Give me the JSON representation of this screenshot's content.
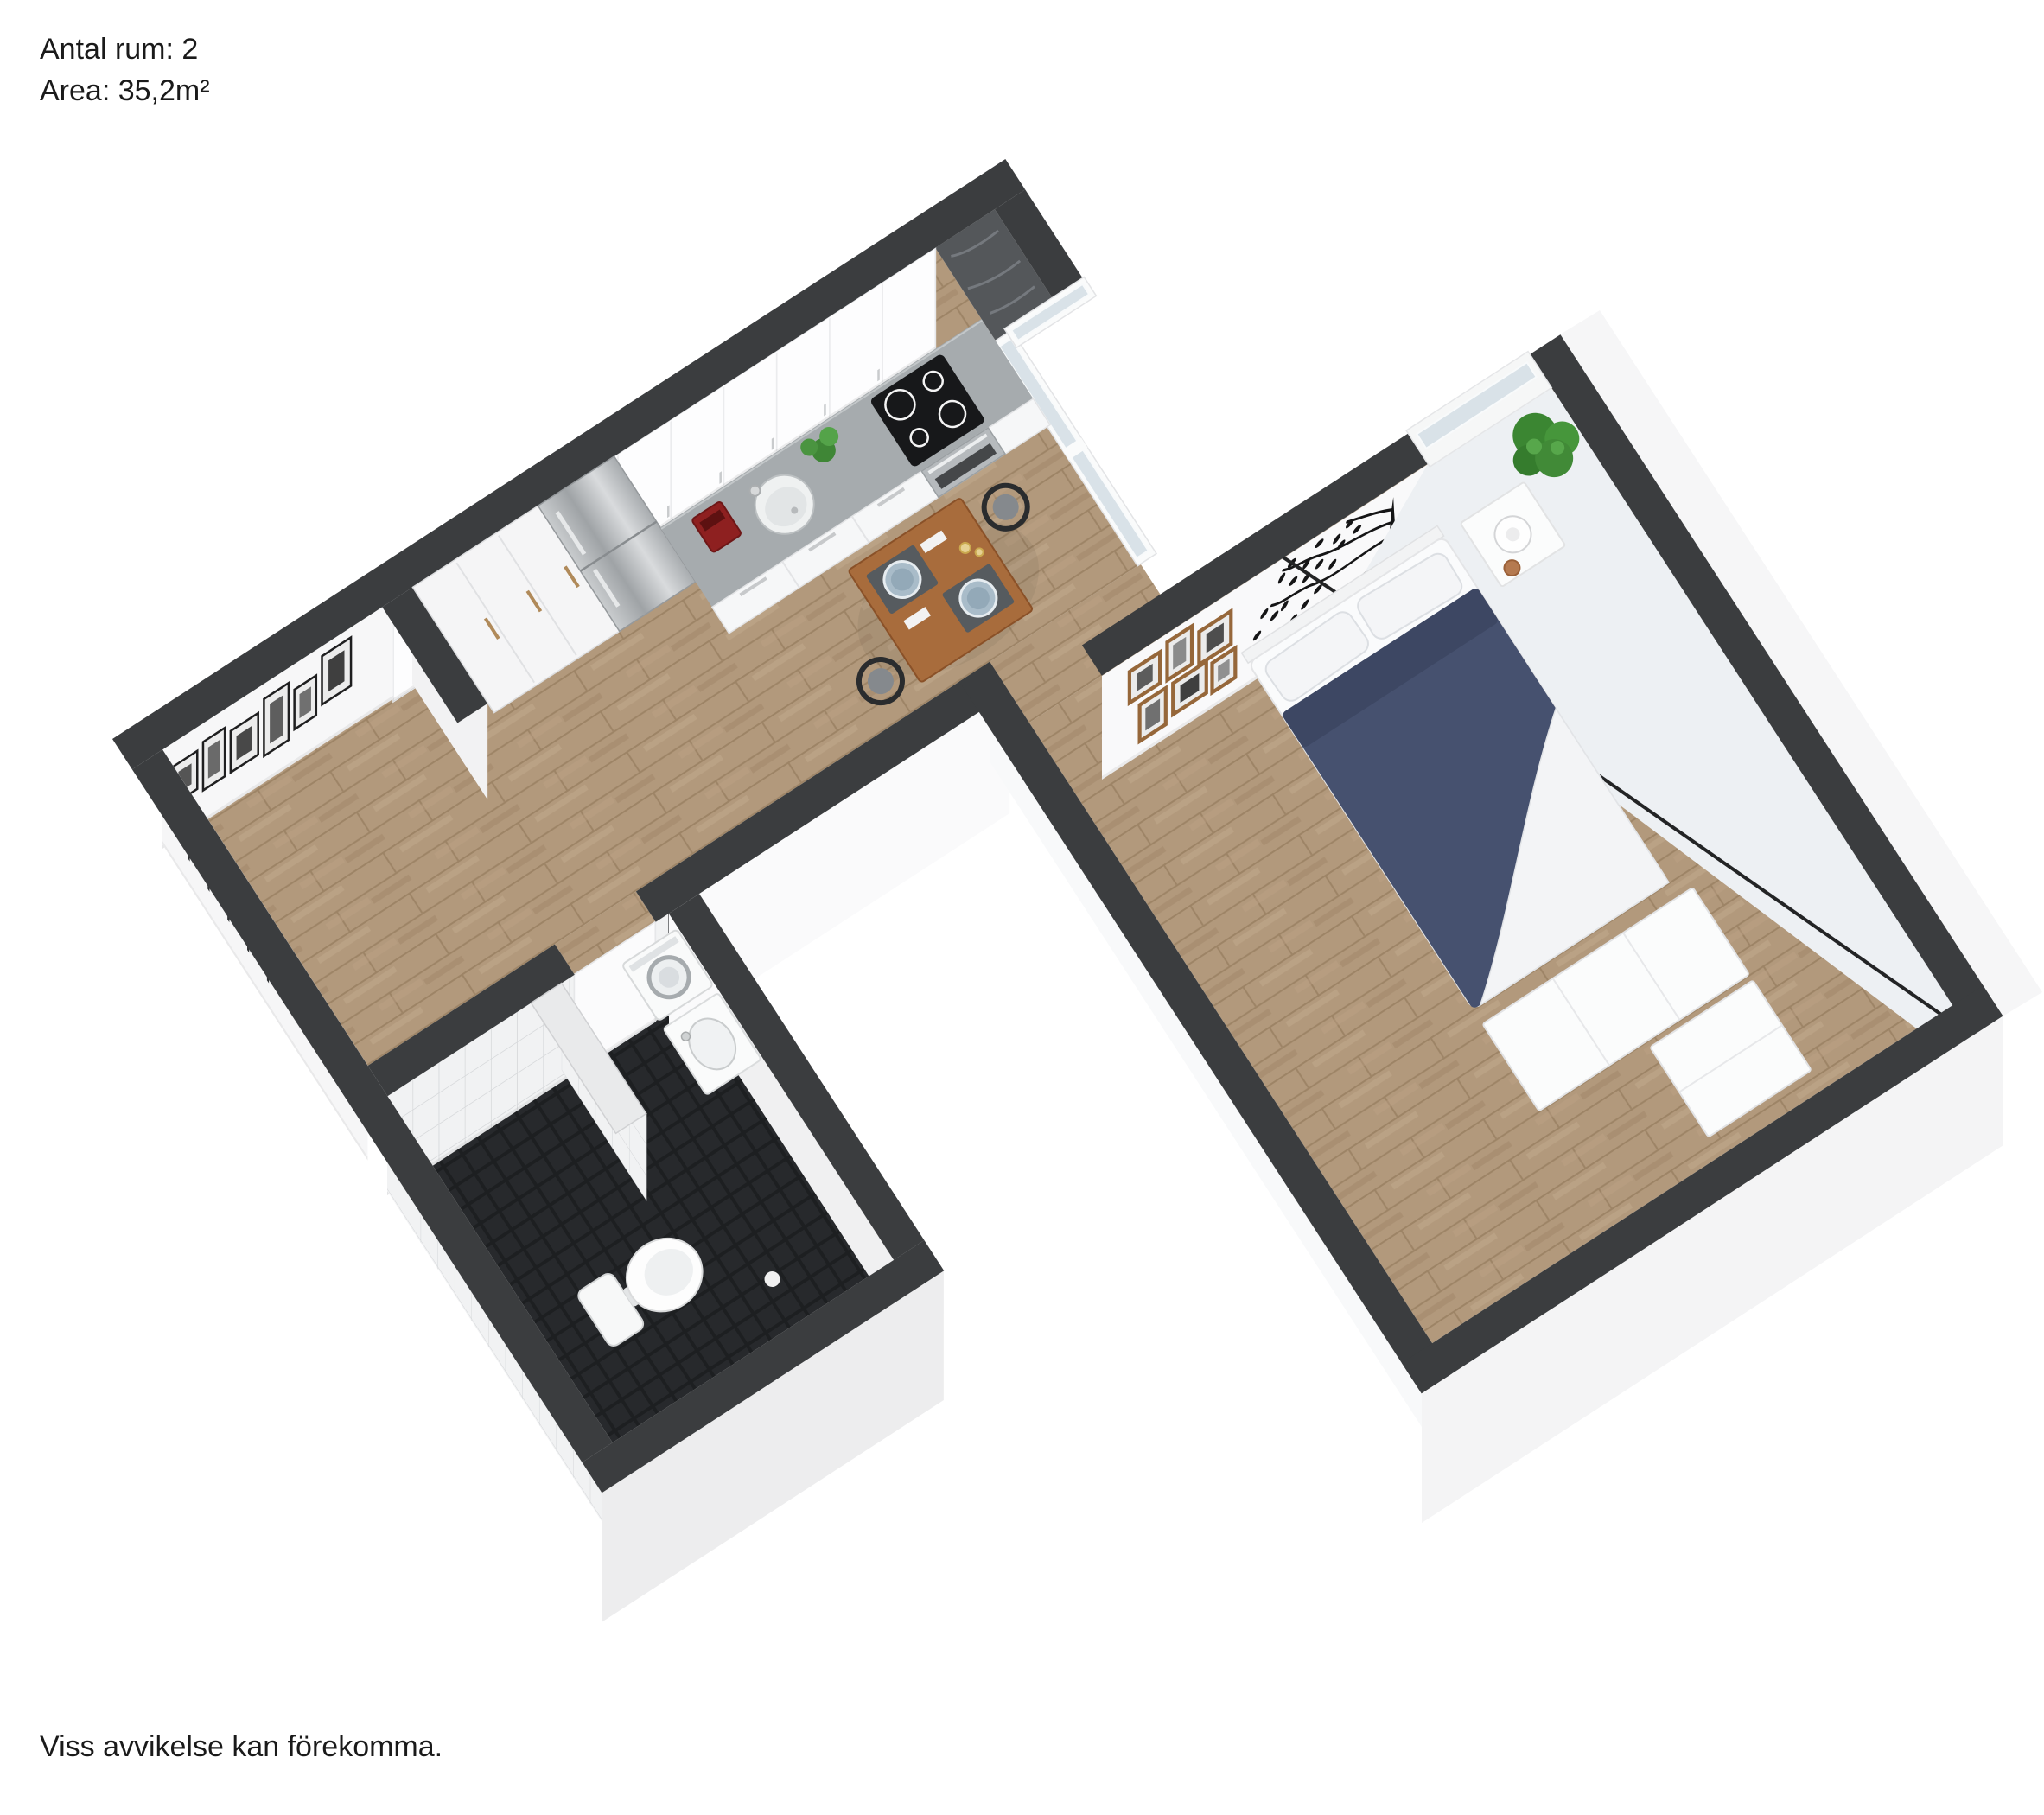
{
  "header": {
    "rooms_line": "Antal rum: 2",
    "area_line": "Area: 35,2m²",
    "rooms_label": "Antal rum",
    "rooms_value": "2",
    "area_label": "Area",
    "area_value": "35,2m²"
  },
  "footer": {
    "disclaimer": "Viss avvikelse kan förekomma."
  },
  "floor_plan": {
    "type": "3d-rendered-floor-plan",
    "projection": "rotated top-down axonometric, plan rotated about -33 degrees",
    "rooms": [
      {
        "name": "hall",
        "features": [
          "coat-rack",
          "black-and-white-framed-photos",
          "wood-floor"
        ]
      },
      {
        "name": "bathroom",
        "features": [
          "toilet",
          "washing-machine",
          "vanity-sink",
          "tiled-partition-wall",
          "white-wall-tiles",
          "black-mosaic-floor",
          "door-to-hall"
        ]
      },
      {
        "name": "kitchen",
        "features": [
          "tall-wardrobe-cabinets",
          "stainless-fridge-freezer",
          "floating-upper-cabinets",
          "concrete-countertop",
          "round-sink",
          "red-coffee-maker",
          "potted-herb",
          "black-induction-hob",
          "stainless-oven",
          "drawer-fronts",
          "window-bay-with-dark-sill"
        ]
      },
      {
        "name": "living-dining",
        "features": [
          "square-wood-dining-table",
          "two-black-wishbone-chairs",
          "place-settings-with-blue-plates",
          "candles",
          "glazed-balcony-door"
        ]
      },
      {
        "name": "bedroom",
        "features": [
          "double-bed",
          "navy-duvet",
          "white-pillows",
          "white-dressers-at-foot",
          "nightstand",
          "ball-table-lamp",
          "green-potted-plant",
          "black-tree-wall-decal",
          "wooden-photo-frame-cluster",
          "window-strip"
        ]
      },
      {
        "name": "balcony",
        "features": [
          "glass-railing",
          "light-floor"
        ]
      }
    ],
    "colors": {
      "wall_top": "#3b3d3f",
      "wood_floor": "#b2997c",
      "bathroom_floor": "#26282b",
      "wall_tile": "#f1f2f3",
      "glass": "#d9e2e8",
      "duvet_navy": "#46516f",
      "countertop": "#a6abae",
      "dining_table": "#a86c3c",
      "coffee_maker_red": "#8e2020",
      "plant_green": "#3f8636",
      "frame_wood": "#96673a",
      "background": "#ffffff"
    }
  }
}
